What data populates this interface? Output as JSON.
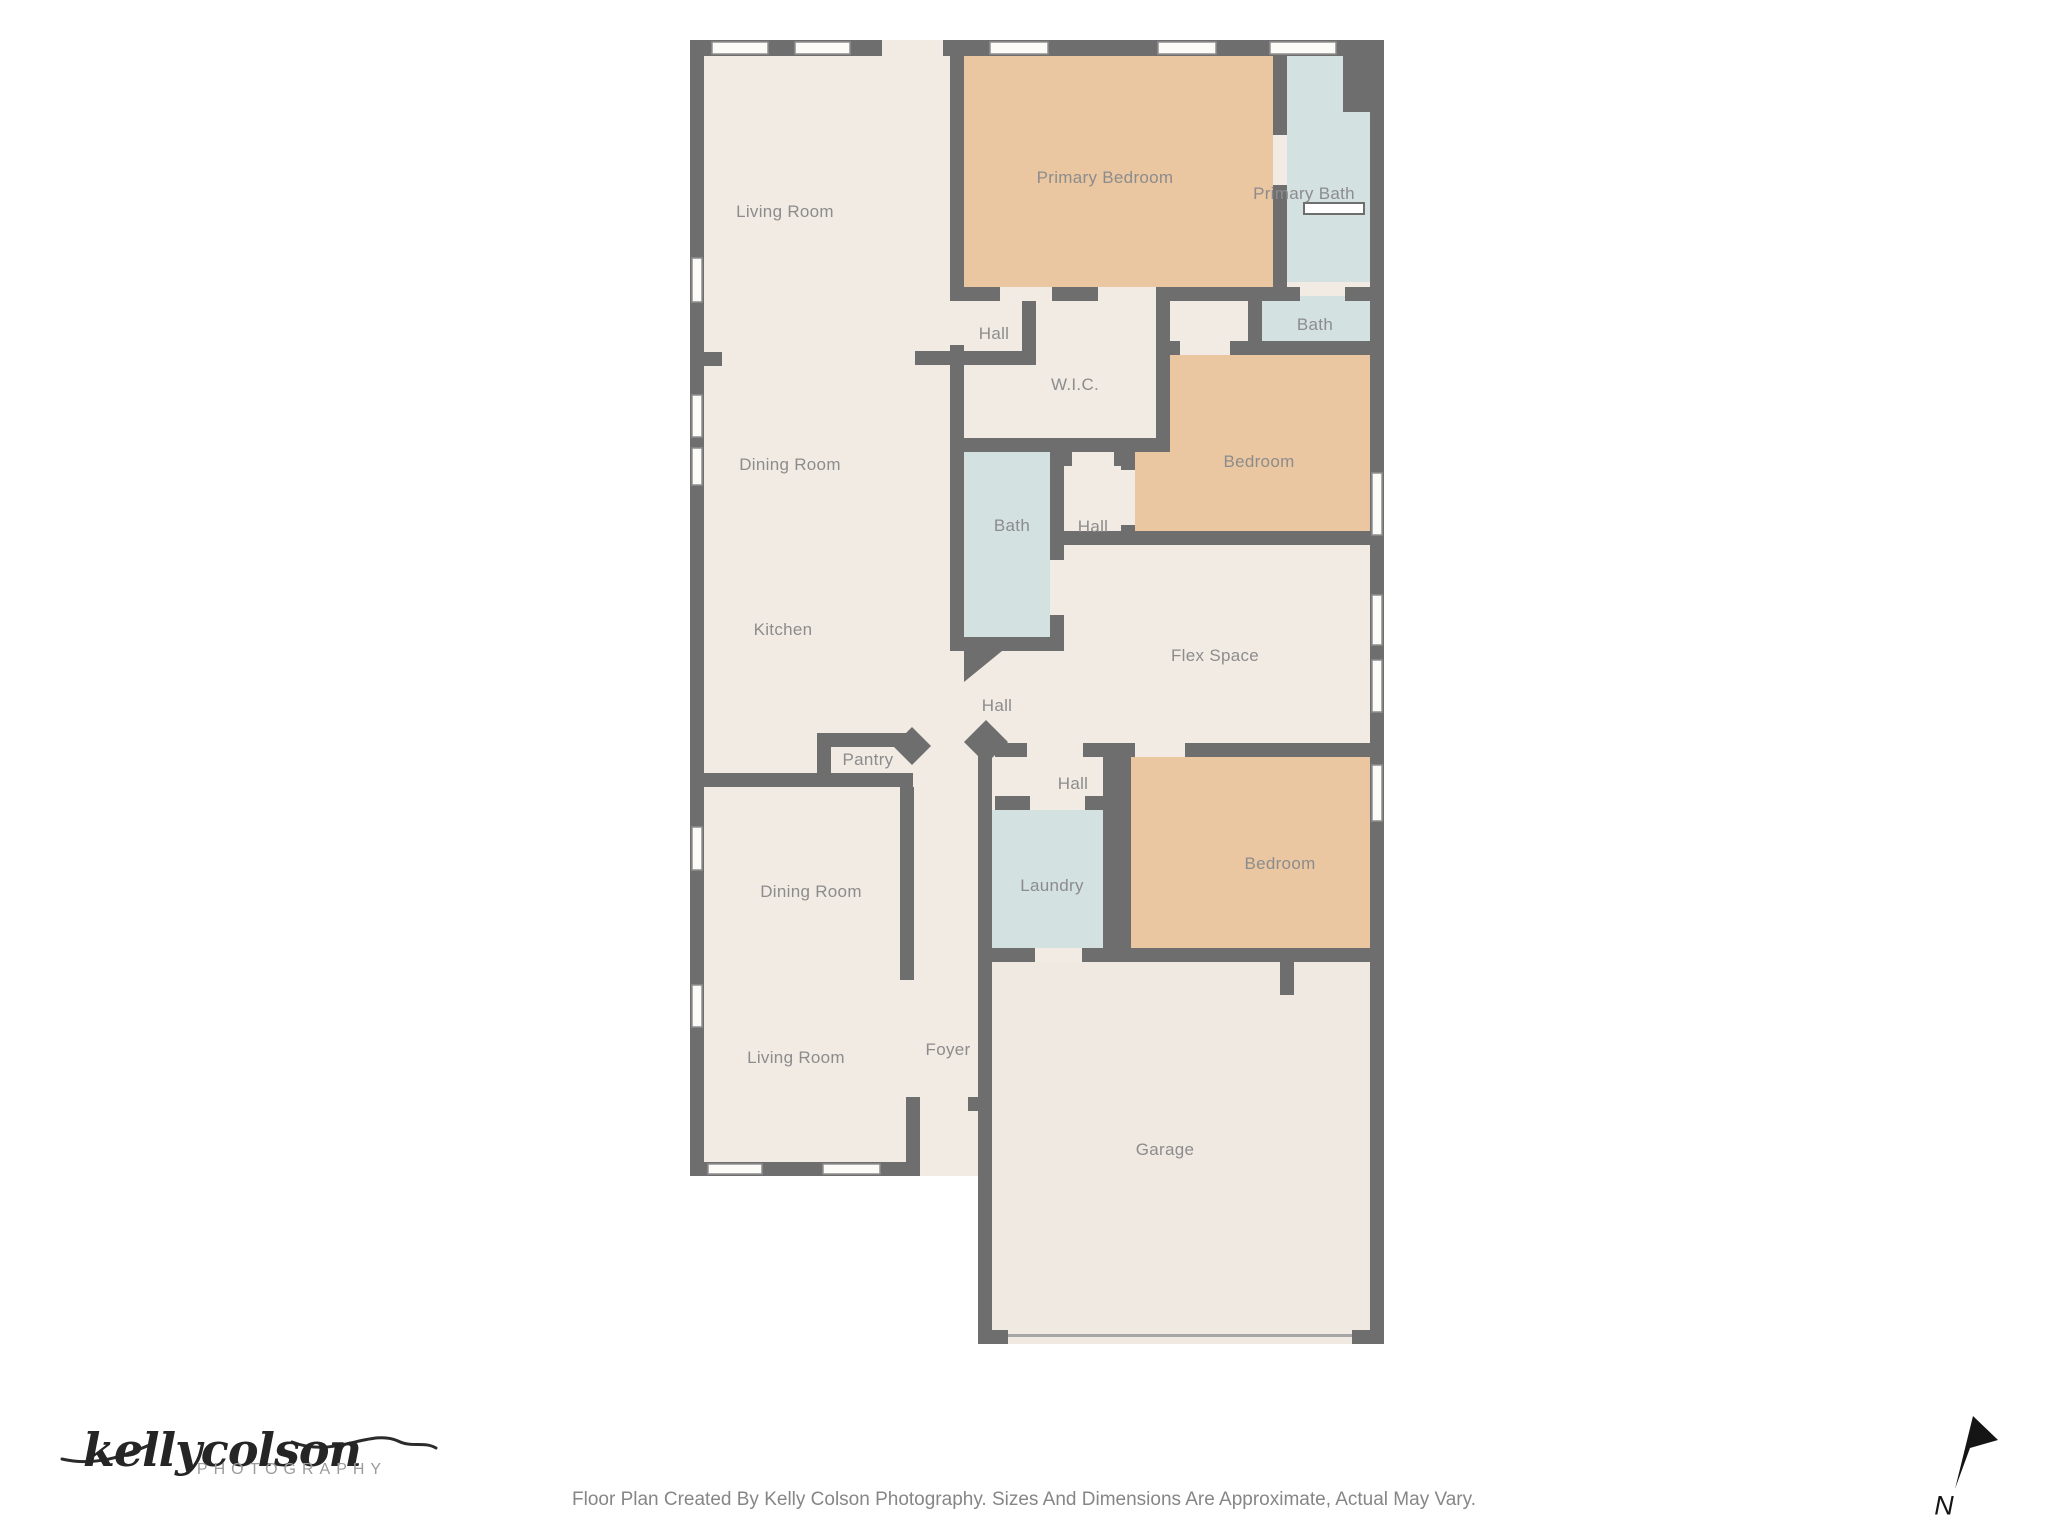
{
  "title": "Floor Plan",
  "footer": {
    "disclaimer": "Floor Plan Created By Kelly Colson Photography. Sizes And Dimensions Are Approximate, Actual May Vary."
  },
  "logo": {
    "script": "kellycolson",
    "subtitle": "PHOTOGRAPHY"
  },
  "compass": {
    "label": "N"
  },
  "colors": {
    "wall": "#6e6e6e",
    "floor": "#f2ebe4",
    "bedroom_fill": "#eac7a1",
    "bath_fill": "#d3e1e0",
    "label_text": "#8c8c8c",
    "window_fill": "#fcfbf8",
    "north_arrow": "#151515"
  },
  "rooms": [
    {
      "label": "Living Room"
    },
    {
      "label": "Primary Bedroom"
    },
    {
      "label": "Primary Bath"
    },
    {
      "label": "Hall"
    },
    {
      "label": "W.I.C."
    },
    {
      "label": "Bath"
    },
    {
      "label": "Dining Room"
    },
    {
      "label": "Bedroom"
    },
    {
      "label": "Bath"
    },
    {
      "label": "Hall"
    },
    {
      "label": "Kitchen"
    },
    {
      "label": "Flex Space"
    },
    {
      "label": "Hall"
    },
    {
      "label": "Pantry"
    },
    {
      "label": "Hall"
    },
    {
      "label": "Dining Room"
    },
    {
      "label": "Laundry"
    },
    {
      "label": "Bedroom"
    },
    {
      "label": "Foyer"
    },
    {
      "label": "Living Room"
    },
    {
      "label": "Garage"
    }
  ]
}
